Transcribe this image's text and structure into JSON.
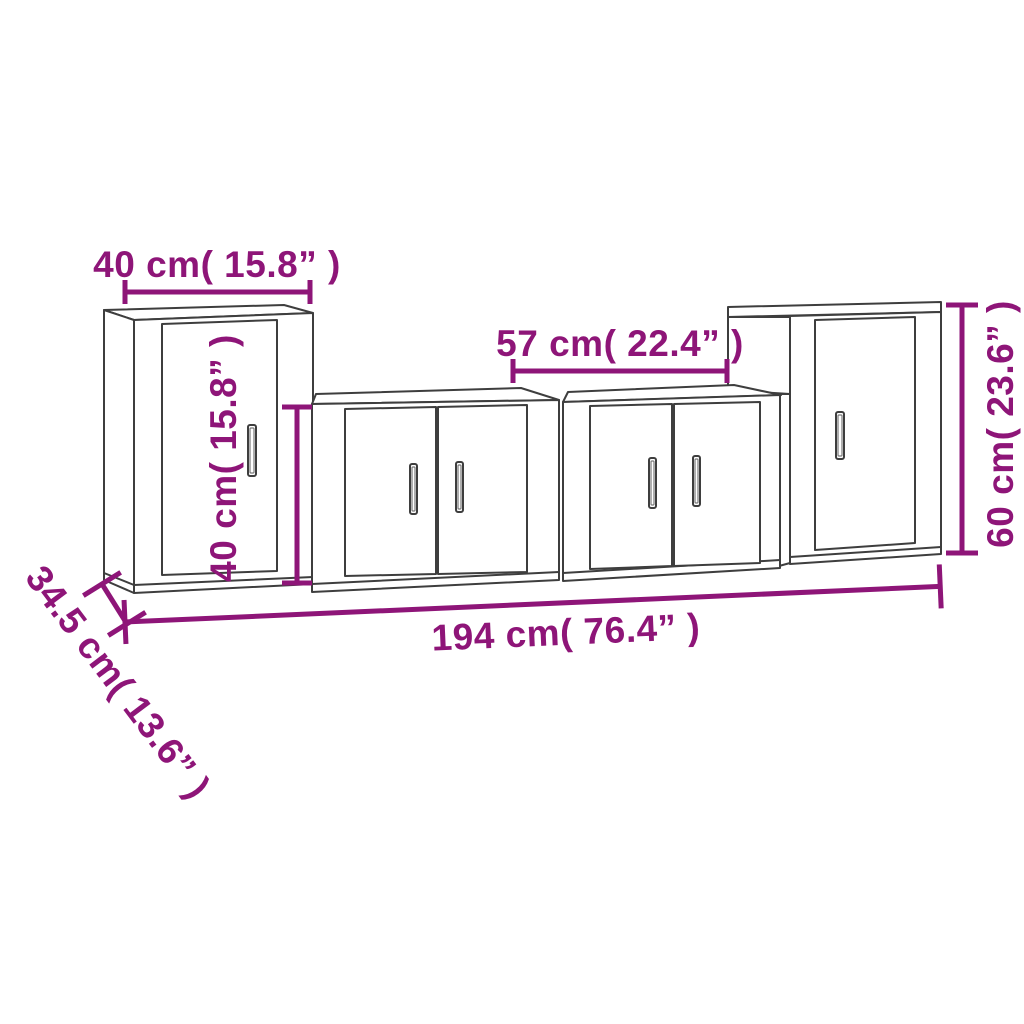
{
  "diagram": {
    "kind": "furniture-dimension-line-drawing",
    "subject": "4-piece TV wall cabinet set",
    "background_color": "#ffffff",
    "accent_color": "#8e1578",
    "outline_color": "#3e3e3e",
    "pieces": [
      {
        "name": "left-tall-cabinet",
        "doors": 1
      },
      {
        "name": "center-left-cabinet",
        "doors": 2
      },
      {
        "name": "center-right-cabinet",
        "doors": 2
      },
      {
        "name": "right-tall-cabinet",
        "doors": 1
      }
    ],
    "dims": {
      "left_width": {
        "label": "40 cm( 15.8” )",
        "value_cm": 40,
        "value_inch": 15.8
      },
      "center_width": {
        "label": "57 cm( 22.4” )",
        "value_cm": 57,
        "value_inch": 22.4
      },
      "center_height": {
        "label": "40 cm( 15.8” )",
        "value_cm": 40,
        "value_inch": 15.8
      },
      "right_height": {
        "label": "60 cm( 23.6” )",
        "value_cm": 60,
        "value_inch": 23.6
      },
      "total_width": {
        "label": "194 cm( 76.4” )",
        "value_cm": 194,
        "value_inch": 76.4
      },
      "depth": {
        "label": "34.5 cm( 13.6” )",
        "value_cm": 34.5,
        "value_inch": 13.6
      }
    }
  }
}
